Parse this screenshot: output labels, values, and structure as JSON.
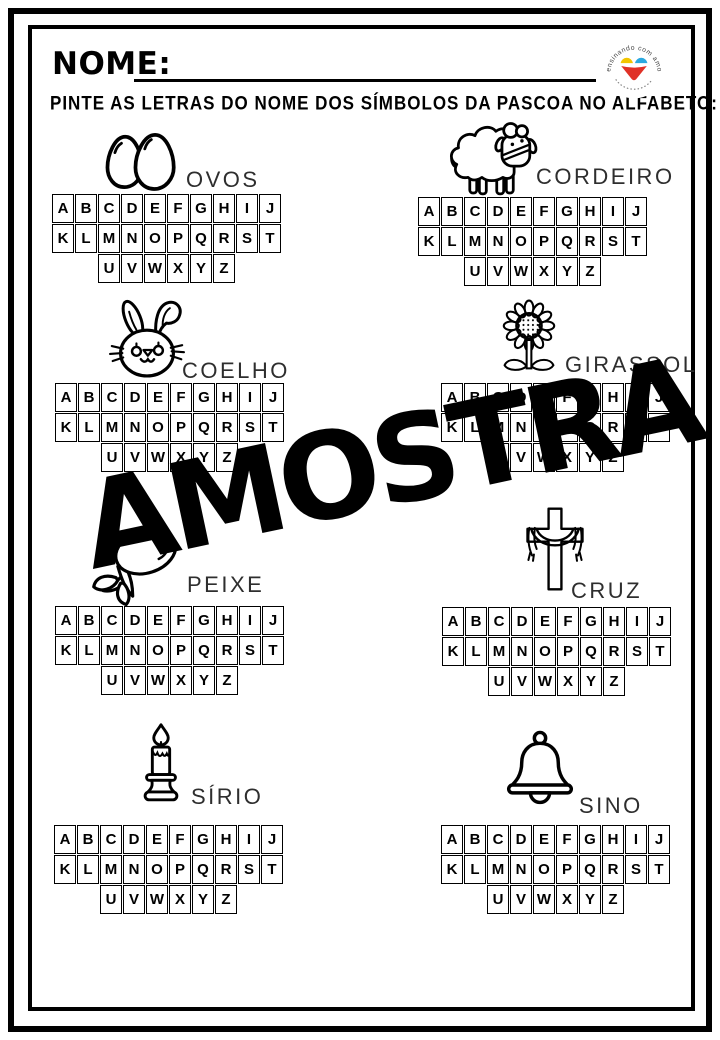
{
  "page": {
    "name_label": "NOME:",
    "instruction": "PINTE AS LETRAS DO NOME DOS SÍMBOLOS DA PASCOA NO ALFABETO:",
    "watermark": "AMOSTRA"
  },
  "logo": {
    "arc_text": "ensinando com amor",
    "colors": {
      "heart_yellow": "#F2C500",
      "heart_blue": "#2BA9E0",
      "heart_red": "#E03127"
    }
  },
  "alphabet": {
    "rows": [
      [
        "A",
        "B",
        "C",
        "D",
        "E",
        "F",
        "G",
        "H",
        "I",
        "J"
      ],
      [
        "K",
        "L",
        "M",
        "N",
        "O",
        "P",
        "Q",
        "R",
        "S",
        "T"
      ],
      [
        "U",
        "V",
        "W",
        "X",
        "Y",
        "Z"
      ]
    ]
  },
  "sections": [
    {
      "id": "ovos",
      "label": "OVOS",
      "icon": "eggs-icon"
    },
    {
      "id": "cordeiro",
      "label": "CORDEIRO",
      "icon": "lamb-icon"
    },
    {
      "id": "coelho",
      "label": "COELHO",
      "icon": "rabbit-icon"
    },
    {
      "id": "girassol",
      "label": "GIRASSOL",
      "icon": "sunflower-icon"
    },
    {
      "id": "peixe",
      "label": "PEIXE",
      "icon": "fish-icon"
    },
    {
      "id": "cruz",
      "label": "CRUZ",
      "icon": "cross-icon"
    },
    {
      "id": "sirio",
      "label": "SÍRIO",
      "icon": "candle-icon"
    },
    {
      "id": "sino",
      "label": "SINO",
      "icon": "bell-icon"
    }
  ]
}
